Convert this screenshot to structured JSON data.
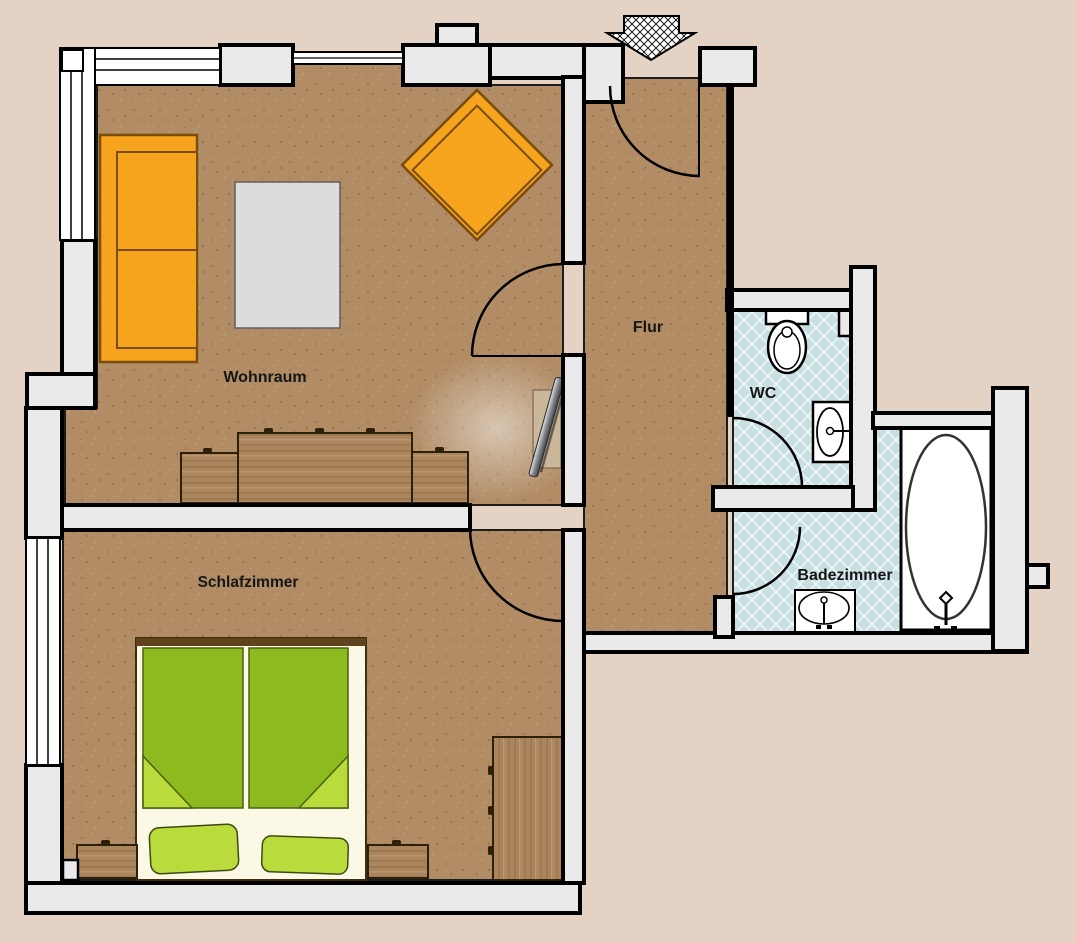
{
  "plan": {
    "type": "apartment-floor-plan",
    "rooms": {
      "wohnraum": {
        "label": "Wohnraum"
      },
      "schlafzimmer": {
        "label": "Schlafzimmer"
      },
      "flur": {
        "label": "Flur"
      },
      "wc": {
        "label": "WC"
      },
      "badezimmer": {
        "label": "Badezimmer"
      }
    },
    "entrance_marker": "entrance-arrow",
    "furniture": [
      "sofa",
      "armchair",
      "rug",
      "sideboard",
      "tv",
      "double-bed",
      "pillows",
      "nightstand-left",
      "nightstand-right",
      "wardrobe",
      "toilet",
      "wc-sink",
      "bath-sink",
      "bathtub",
      "corner-window",
      "bedroom-window",
      "interior-doors"
    ],
    "colors": {
      "background": "#e4d3c4",
      "floor_wood": "#b18c65",
      "wall_fill": "#eaeaea",
      "outline": "#000000",
      "tile_blue": "#c9e0e3",
      "sofa_orange": "#f6a41e",
      "bed_green": "#8dbb1f",
      "pillow_green": "#b9dc3c",
      "furniture_wood": "#aa855d",
      "fixture_white": "#ffffff",
      "rug_gray": "#dcdcdc"
    }
  }
}
